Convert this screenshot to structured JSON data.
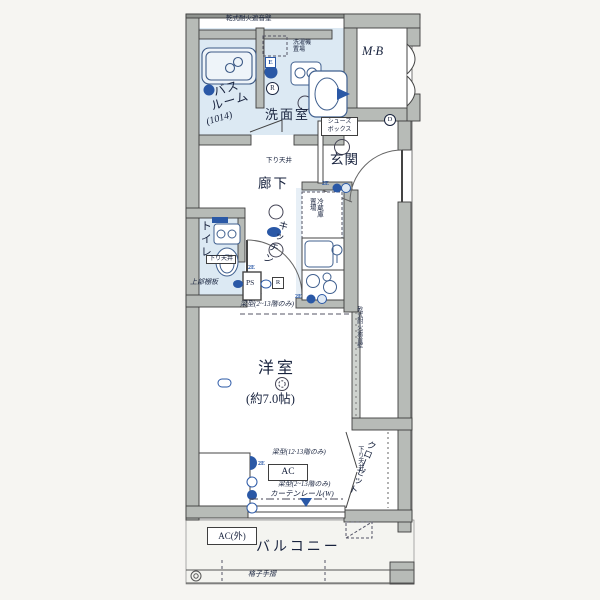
{
  "rooms": {
    "bath_name": "バス\nルーム",
    "bath_size": "(1014)",
    "washroom": "洗面室",
    "meter_box": "M·B",
    "entrance": "玄関",
    "corridor": "廊下",
    "toilet": "トイレ",
    "kitchen": "キッチン",
    "western_room": "洋室",
    "western_room_size": "(約7.0帖)",
    "closet": "クローゼット",
    "balcony": "バルコニー"
  },
  "fixtures": {
    "laundry_place": "洗濯機\n置場",
    "shoes_box": "シューズ\nボックス",
    "fridge_place": "冷蔵庫\n置場",
    "upper_shelf": "上部棚板",
    "pipe_space": "PS",
    "ac_unit": "AC",
    "ac_outdoor": "AC(外)",
    "handrail": "格子手摺"
  },
  "notes": {
    "wall_top": "乾式耐火遮音壁",
    "wall_right": "乾式耐火遮音壁",
    "lowered_ceiling_corridor": "下り天井",
    "lowered_ceiling_toilet": "下り天井",
    "lowered_ceiling_closet": "下り天井",
    "beam_top": "梁型(2~13階のみ)",
    "beam_mid": "梁型(12·13階のみ)",
    "beam_bottom": "梁型(2~13階のみ)",
    "curtain_rail": "カーテンレール(W)"
  },
  "marks": {
    "e": "E",
    "r_washroom": "R",
    "r_corridor": "R",
    "d": "D",
    "e2_fridge": "2E",
    "e2_kitchen": "2E",
    "e2_toilet": "2E",
    "e2_room": "2E"
  },
  "colors": {
    "wall_gray": "#b7bbb7",
    "wet_area": "#dce9f3",
    "fixture_navy": "#2a58a6",
    "ink": "#17223d"
  }
}
